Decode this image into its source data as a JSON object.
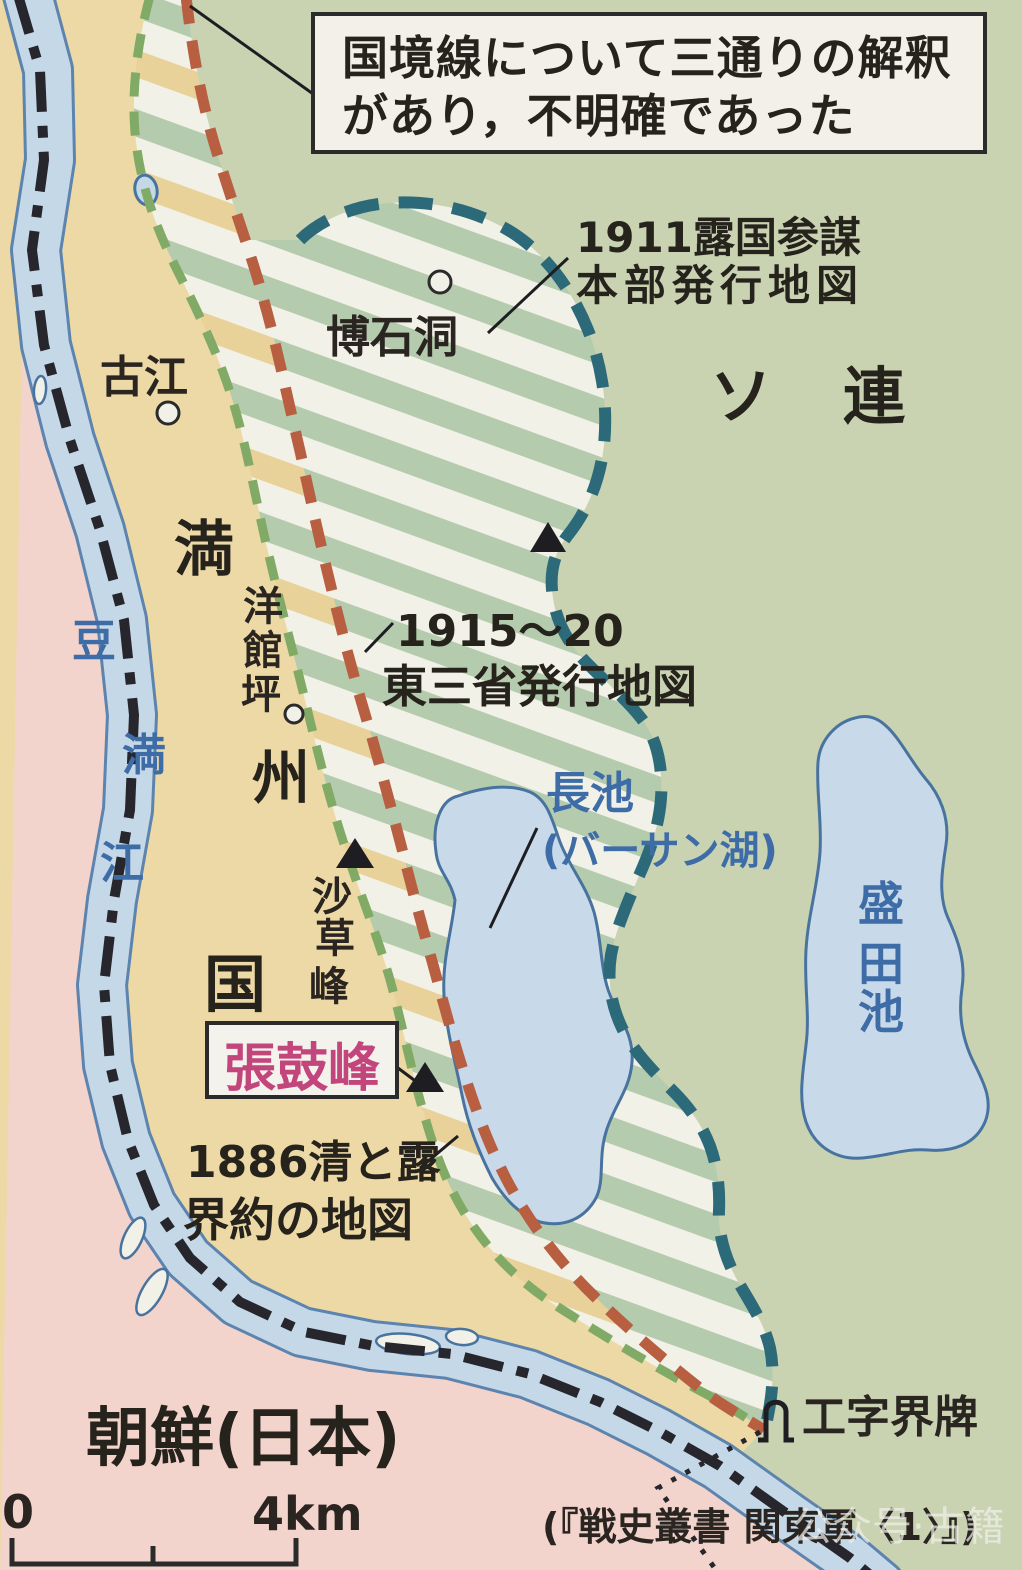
{
  "note_box": {
    "line1": "国境線について三通りの解釈",
    "line2": "があり，不明確であった"
  },
  "boundary_labels": {
    "map1911": {
      "line1": "1911露国参謀",
      "line2": "本部発行地図"
    },
    "map1915": {
      "line1": "1915〜20",
      "line2": "東三省発行地図"
    },
    "map1886": {
      "line1": "1886清と露",
      "line2": "界約の地図"
    }
  },
  "regions": {
    "soviet": "ソ連",
    "manchukuo": "満州国",
    "korea": "朝鮮(日本)"
  },
  "water": {
    "tumen_river": "豆満江",
    "lake_khasan_line1": "長池",
    "lake_khasan_line2": "(バーサン湖)",
    "lake_morita": "盛田池"
  },
  "places": {
    "kokou": "古江",
    "hakusekidou": "博石洞",
    "youkanhei": "洋館坪",
    "sasouhou": "沙草峰",
    "choukohou": "張鼓峰",
    "kojikaihai": "工字界牌"
  },
  "scale_bar": {
    "zero": "0",
    "four_km": "4km"
  },
  "source_citation": "(『戦史叢書 関東軍〈1〉』)",
  "watermark": "公众号·古籍",
  "colors": {
    "soviet_green": "#c9d3b2",
    "manchukuo_tan": "#edd9a5",
    "korea_pink": "#f3d4cc",
    "river_blue": "#c5d8e8",
    "hatch_green": "#b5cbad",
    "hatch_white": "#f2f1e7",
    "hatch_tan": "#e9d299",
    "line_1886_green": "#80aa66",
    "line_1915_red": "#b85f42",
    "line_1911_teal": "#2d6a79",
    "border_black": "#26262c",
    "label_blue": "#3e6ca6",
    "peak_magenta": "#c2457c"
  }
}
